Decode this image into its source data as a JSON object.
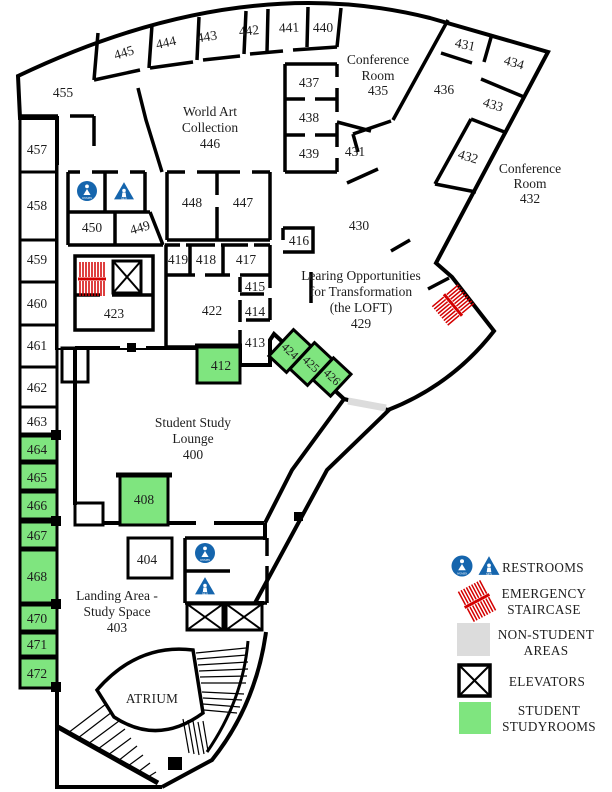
{
  "rooms": {
    "400": "400",
    "403": "403",
    "404": "404",
    "408": "408",
    "412": "412",
    "413": "413",
    "414": "414",
    "415": "415",
    "416": "416",
    "417": "417",
    "418": "418",
    "419": "419",
    "422": "422",
    "423": "423",
    "424": "424",
    "425": "425",
    "426": "426",
    "429": "429",
    "430": "430",
    "431": "431",
    "432": "432",
    "433": "433",
    "434": "434",
    "435": "435",
    "436": "436",
    "437": "437",
    "438": "438",
    "439": "439",
    "440": "440",
    "441": "441",
    "442": "442",
    "443": "443",
    "444": "444",
    "445": "445",
    "446": "446",
    "447": "447",
    "448": "448",
    "449": "449",
    "450": "450",
    "455": "455",
    "457": "457",
    "458": "458",
    "459": "459",
    "460": "460",
    "461": "461",
    "462": "462",
    "463": "463",
    "464": "464",
    "465": "465",
    "466": "466",
    "467": "467",
    "468": "468",
    "470": "470",
    "471": "471",
    "472": "472"
  },
  "areas": {
    "world_art": {
      "l1": "World Art",
      "l2": "Collection",
      "num": "446"
    },
    "conference_435": {
      "l1": "Conference",
      "l2": "Room",
      "num": "435"
    },
    "conference_432": {
      "l1": "Conference",
      "l2": "Room",
      "num": "432"
    },
    "loft": {
      "l1": "Learing Opportunities",
      "l2": "for Transformation",
      "l3": "(the LOFT)",
      "num": "429"
    },
    "lounge": {
      "l1": "Student Study",
      "l2": "Lounge",
      "num": "400"
    },
    "landing": {
      "l1": "Landing Area -",
      "l2": "Study Space",
      "num": "403"
    },
    "atrium": {
      "name": "ATRIUM"
    }
  },
  "legend": {
    "restrooms": "RESTROOMS",
    "emergency_1": "EMERGENCY",
    "emergency_2": "STAIRCASE",
    "non_student_1": "NON-STUDENT",
    "non_student_2": "AREAS",
    "elevators": "ELEVATORS",
    "student_1": "STUDENT",
    "student_2": "STUDYROOMS"
  },
  "icon_text": {
    "women": "WOMEN",
    "men": "MEN"
  },
  "colors": {
    "non_student": "#dcdcdc",
    "studyroom": "#7fe57f",
    "restroom_blue": "#1565ad",
    "staircase_red": "#d40000"
  }
}
